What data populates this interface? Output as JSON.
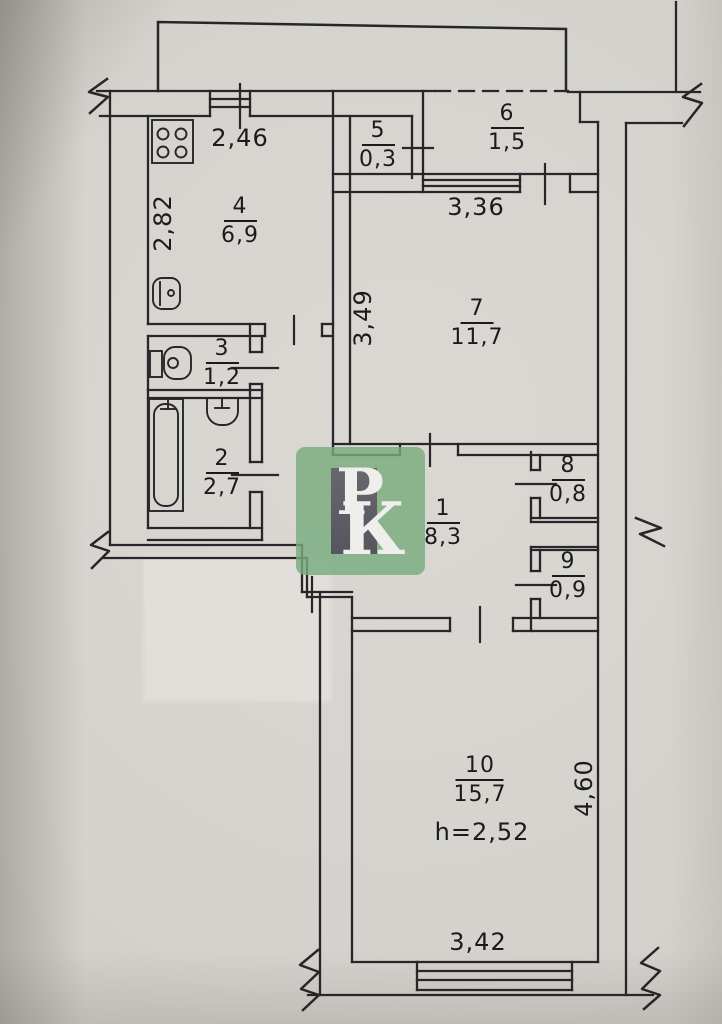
{
  "plan_type": "apartment floor plan (BTI drawing)",
  "rooms": [
    {
      "id": "1",
      "area": "8,3"
    },
    {
      "id": "2",
      "area": "2,7"
    },
    {
      "id": "3",
      "area": "1,2"
    },
    {
      "id": "4",
      "area": "6,9"
    },
    {
      "id": "5",
      "area": "0,3"
    },
    {
      "id": "6",
      "area": "1,5"
    },
    {
      "id": "7",
      "area": "11,7"
    },
    {
      "id": "8",
      "area": "0,8"
    },
    {
      "id": "9",
      "area": "0,9"
    },
    {
      "id": "10",
      "area": "15,7",
      "ceiling_height": "h=2,52"
    }
  ],
  "dimensions": [
    {
      "name": "kitchen-width",
      "value": "2,46"
    },
    {
      "name": "kitchen-depth",
      "value": "2,82"
    },
    {
      "name": "room7-window-width",
      "value": "3,36"
    },
    {
      "name": "room7-depth",
      "value": "3,49"
    },
    {
      "name": "room10-depth",
      "value": "4,60"
    },
    {
      "name": "room10-window-width",
      "value": "3,42"
    }
  ],
  "watermark": {
    "letter_p": "Р",
    "letter_k": "К"
  },
  "colors": {
    "paper": "#d5d2cd",
    "ink": "#26262b",
    "watermark_green": "#79ac7e",
    "watermark_gray": "#5d5c62",
    "watermark_text": "#f0eeea"
  }
}
